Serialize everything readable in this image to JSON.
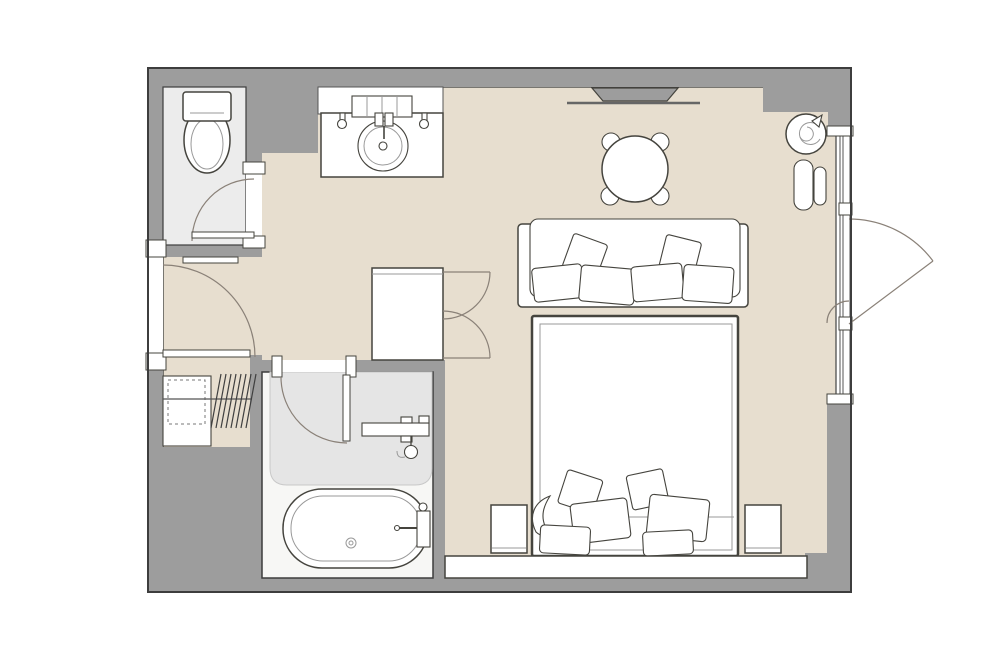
{
  "plan": {
    "rooms": [
      {
        "id": "toilet-room",
        "furniture": [
          "toilet"
        ]
      },
      {
        "id": "vanity-area",
        "furniture": [
          "vanity-counter",
          "round-sink",
          "faucet",
          "glass-shelf",
          "soap-dispenser-left",
          "soap-dispenser-right"
        ]
      },
      {
        "id": "bathroom",
        "furniture": [
          "bathtub",
          "tub-faucet",
          "shower-shelf",
          "hand-shower",
          "wet-zone"
        ]
      },
      {
        "id": "closet",
        "furniture": [
          "dresser",
          "hanging-rail",
          "hangers"
        ]
      },
      {
        "id": "main-room",
        "furniture": [
          "wall-tv",
          "round-table",
          "dining-chairs",
          "sofa",
          "cabinet",
          "double-bed",
          "nightstand-left",
          "nightstand-right",
          "foot-console",
          "plant",
          "lounge-bench"
        ]
      }
    ],
    "doors": [
      {
        "id": "entrance-door",
        "wall": "left",
        "swing": "inward"
      },
      {
        "id": "toilet-door",
        "wall": "toilet-right",
        "swing": "inward"
      },
      {
        "id": "bathroom-door",
        "wall": "bathroom-top",
        "swing": "inward"
      },
      {
        "id": "balcony-door",
        "wall": "right-glazing",
        "swing": "outward"
      }
    ],
    "window": {
      "id": "right-glazing",
      "mullions": 2
    }
  },
  "colors": {
    "background": "#ffffff",
    "wall": "#9d9d9d",
    "wall_outline": "#3d3d3d",
    "floor_main": "#e7decf",
    "floor_bathroom": "#f7f7f5",
    "floor_toilet": "#ececec",
    "wet_zone": "#e5e5e5",
    "furniture": "#ffffff",
    "outline": "#45443e",
    "swing": "#8a8178"
  }
}
